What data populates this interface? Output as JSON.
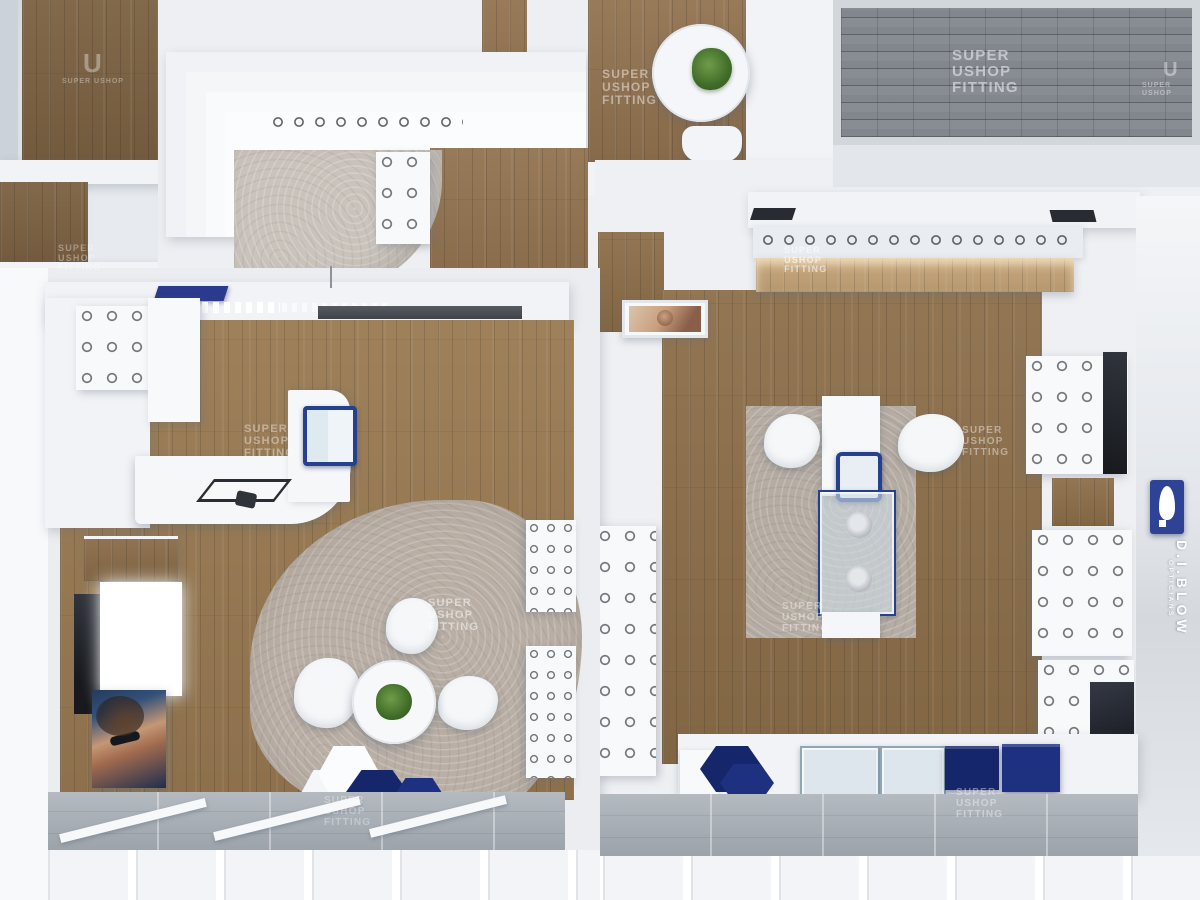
{
  "meta": {
    "title": "Optician retail shop interior — bird's-eye 3D render"
  },
  "watermark": {
    "text": "SUPER\nUSHOP\nFITTING",
    "short": "SUPER USHOP",
    "logo_letter": "U"
  },
  "brand": {
    "name": "D.I.BLOW",
    "tagline": "OPTICIANS"
  },
  "colors": {
    "accent_navy": "#24408f",
    "deep_navy": "#16266b",
    "sign_blue": "#2e4396",
    "wood_floor": "#8d6f4a",
    "wood_lit_shelf": "#c5a478",
    "rug_grey": "#b9afa5",
    "carpet_grey": "#c9c3bc",
    "brick_paving": "#82878e",
    "concrete_walkway": "#a6acb3",
    "wall_white": "#f1f3f6",
    "plant_green": "#4d7a33"
  }
}
